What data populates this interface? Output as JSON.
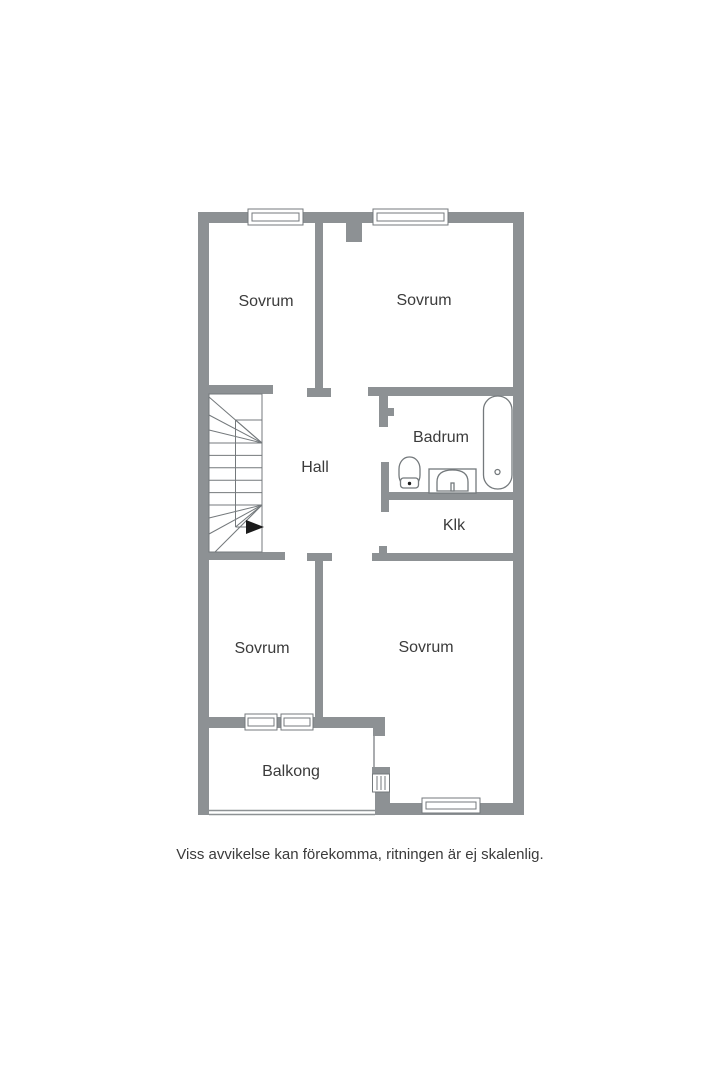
{
  "floorplan": {
    "rooms": [
      {
        "id": "sovrum-top-left",
        "label": "Sovrum"
      },
      {
        "id": "sovrum-top-right",
        "label": "Sovrum"
      },
      {
        "id": "hall",
        "label": "Hall"
      },
      {
        "id": "badrum",
        "label": "Badrum"
      },
      {
        "id": "klk",
        "label": "Klk"
      },
      {
        "id": "sovrum-bottom-left",
        "label": "Sovrum"
      },
      {
        "id": "sovrum-bottom-right",
        "label": "Sovrum"
      },
      {
        "id": "balkong",
        "label": "Balkong"
      }
    ],
    "fixtures": [
      "stairs-icon",
      "direction-arrow-icon",
      "bathtub-icon",
      "toilet-icon",
      "sink-icon",
      "window-icon"
    ],
    "disclaimer": "Viss avvikelse kan förekomma, ritningen är ej skalenlig.",
    "colors": {
      "wall": "#8d9194",
      "line": "#74797c",
      "text": "#3b3b3b",
      "arrow": "#1b1b1b",
      "bg": "#ffffff"
    }
  }
}
